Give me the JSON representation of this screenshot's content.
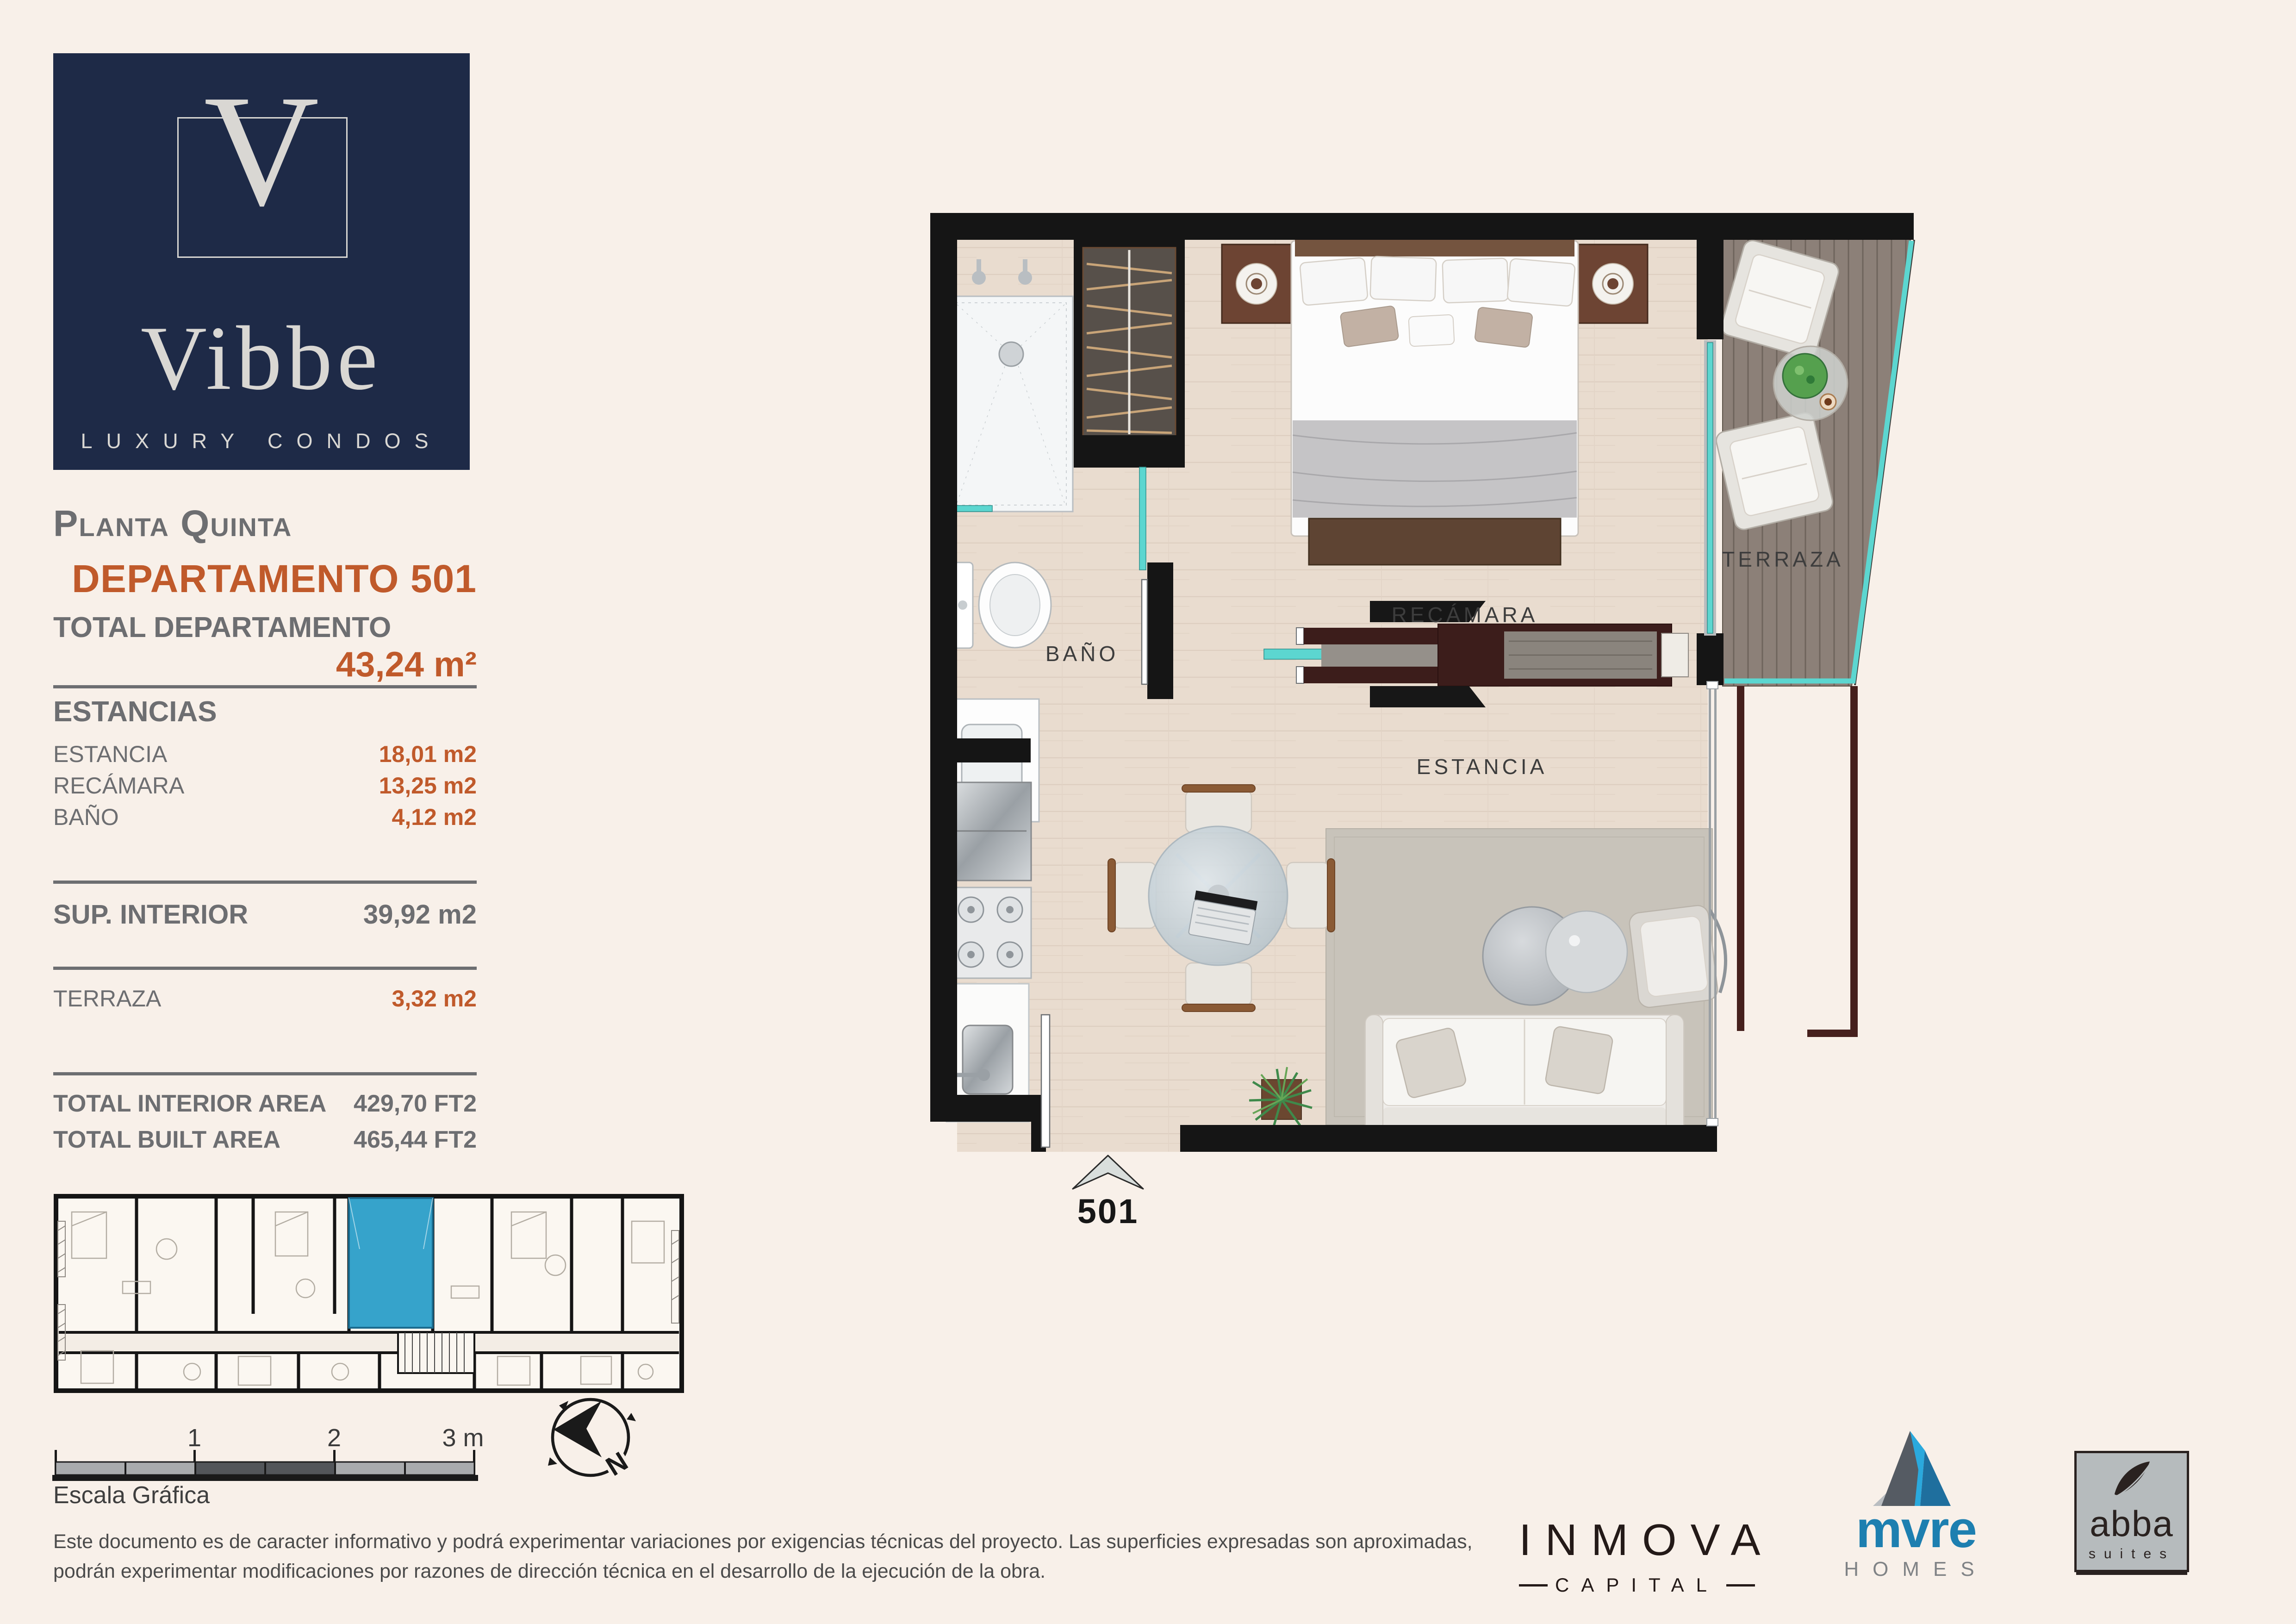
{
  "brand": {
    "initial": "V",
    "name": "Vibbe",
    "tagline": "LUXURY CONDOS"
  },
  "header": {
    "floor": "Planta Quinta",
    "unit": "DEPARTAMENTO 501"
  },
  "summary": {
    "label": "TOTAL DEPARTAMENTO",
    "value": "43,24 m²"
  },
  "estancias": {
    "heading": "ESTANCIAS",
    "rows": [
      {
        "label": "ESTANCIA",
        "value": "18,01 m2"
      },
      {
        "label": "RECÁMARA",
        "value": "13,25 m2"
      },
      {
        "label": "BAÑO",
        "value": "4,12 m2"
      }
    ]
  },
  "interior": {
    "label": "SUP. INTERIOR",
    "value": "39,92 m2"
  },
  "terrace": {
    "label": "TERRAZA",
    "value": "3,32 m2"
  },
  "totals": [
    {
      "label": "TOTAL INTERIOR AREA",
      "value": "429,70 FT2"
    },
    {
      "label": "TOTAL BUILT AREA",
      "value": "465,44 FT2"
    }
  ],
  "plan": {
    "labels": {
      "bano": "BAÑO",
      "recamara": "RECÁMARA",
      "estancia": "ESTANCIA",
      "terraza": "TERRAZA"
    },
    "unit": "501"
  },
  "scalebar": {
    "ticks": [
      "1",
      "2",
      "3 m."
    ],
    "caption": "Escala Gráfica"
  },
  "compass": {
    "north": "N"
  },
  "disclaimer": {
    "line1": "Este documento es de caracter informativo y podrá experimentar variaciones por exigencias técnicas del proyecto. Las superficies expresadas son aproximadas,",
    "line2": "podrán experimentar modificaciones por razones de dirección técnica en el desarrollo de la ejecución de la obra."
  },
  "partners": {
    "inmova": {
      "name": "INMOVA",
      "sub": "CAPITAL"
    },
    "mvre": {
      "name": "mvre",
      "sub": "HOMES"
    },
    "abba": {
      "name": "abba",
      "sub": "suites"
    }
  },
  "colors": {
    "accent_orange": "#c05a2b",
    "brand_navy": "#1e2a47",
    "highlight_blue": "#36a3cb",
    "glass_teal": "#5cd6d0"
  }
}
